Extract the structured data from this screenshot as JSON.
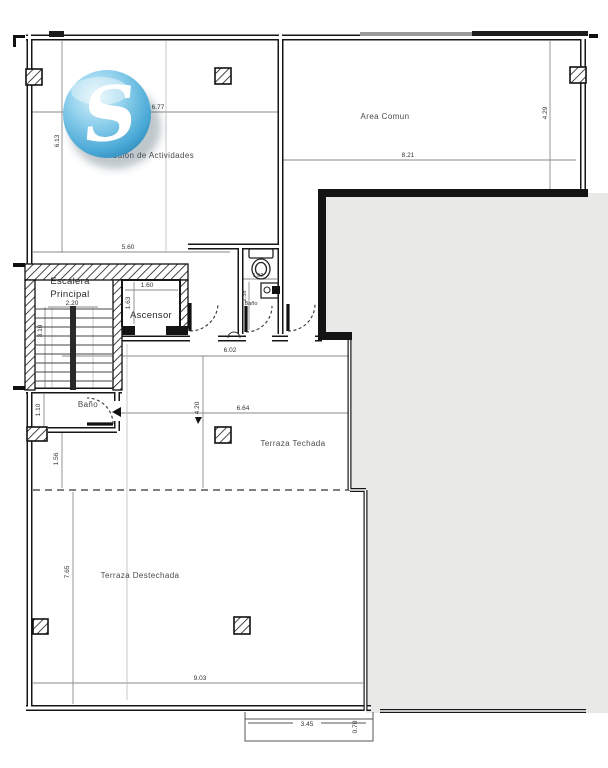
{
  "title": "Planta arquitectonica - nivel terraza",
  "logo": {
    "letter": "S"
  },
  "colors": {
    "masked_area": "#e9e9e8",
    "wall": "#161616",
    "dim_line": "#777777",
    "grid_line": "#bbbbbb",
    "logo_blue": "#4aa9d6",
    "background": "#ffffff"
  },
  "plan": {
    "salon": {
      "label": "Salon de Actividades",
      "dim_width": "6.77",
      "dim_height": "6.13",
      "dim_bottom": "5.60"
    },
    "area_comun": {
      "label": "Area Comun",
      "dim_width": "8.21",
      "dim_height": "4.29"
    },
    "escalera": {
      "label_line1": "Escalera",
      "label_line2": "Principal",
      "dim_width": "2.20",
      "dim_height": "3.10"
    },
    "ascensor": {
      "label": "Ascensor",
      "dim_width": "1.60",
      "dim_height": "1.63"
    },
    "bano_central": {
      "label": "Baño",
      "dim_width": "1.02",
      "dim_height": "2.38"
    },
    "bano_izquierdo": {
      "label": "Baño",
      "dim_height": "1.10"
    },
    "hall": {
      "dim_width": "6.02"
    },
    "terraza_techada": {
      "label": "Terraza Techada",
      "dim_width": "6.64",
      "dim_height": "4.20"
    },
    "terraza_destechada": {
      "label": "Terraza Destechada",
      "dim_width": "9.03",
      "dim_height": "7.65",
      "dim_upper": "1.56"
    },
    "escalon": {
      "dim_width": "3.45",
      "dim_depth": "0.70"
    }
  }
}
